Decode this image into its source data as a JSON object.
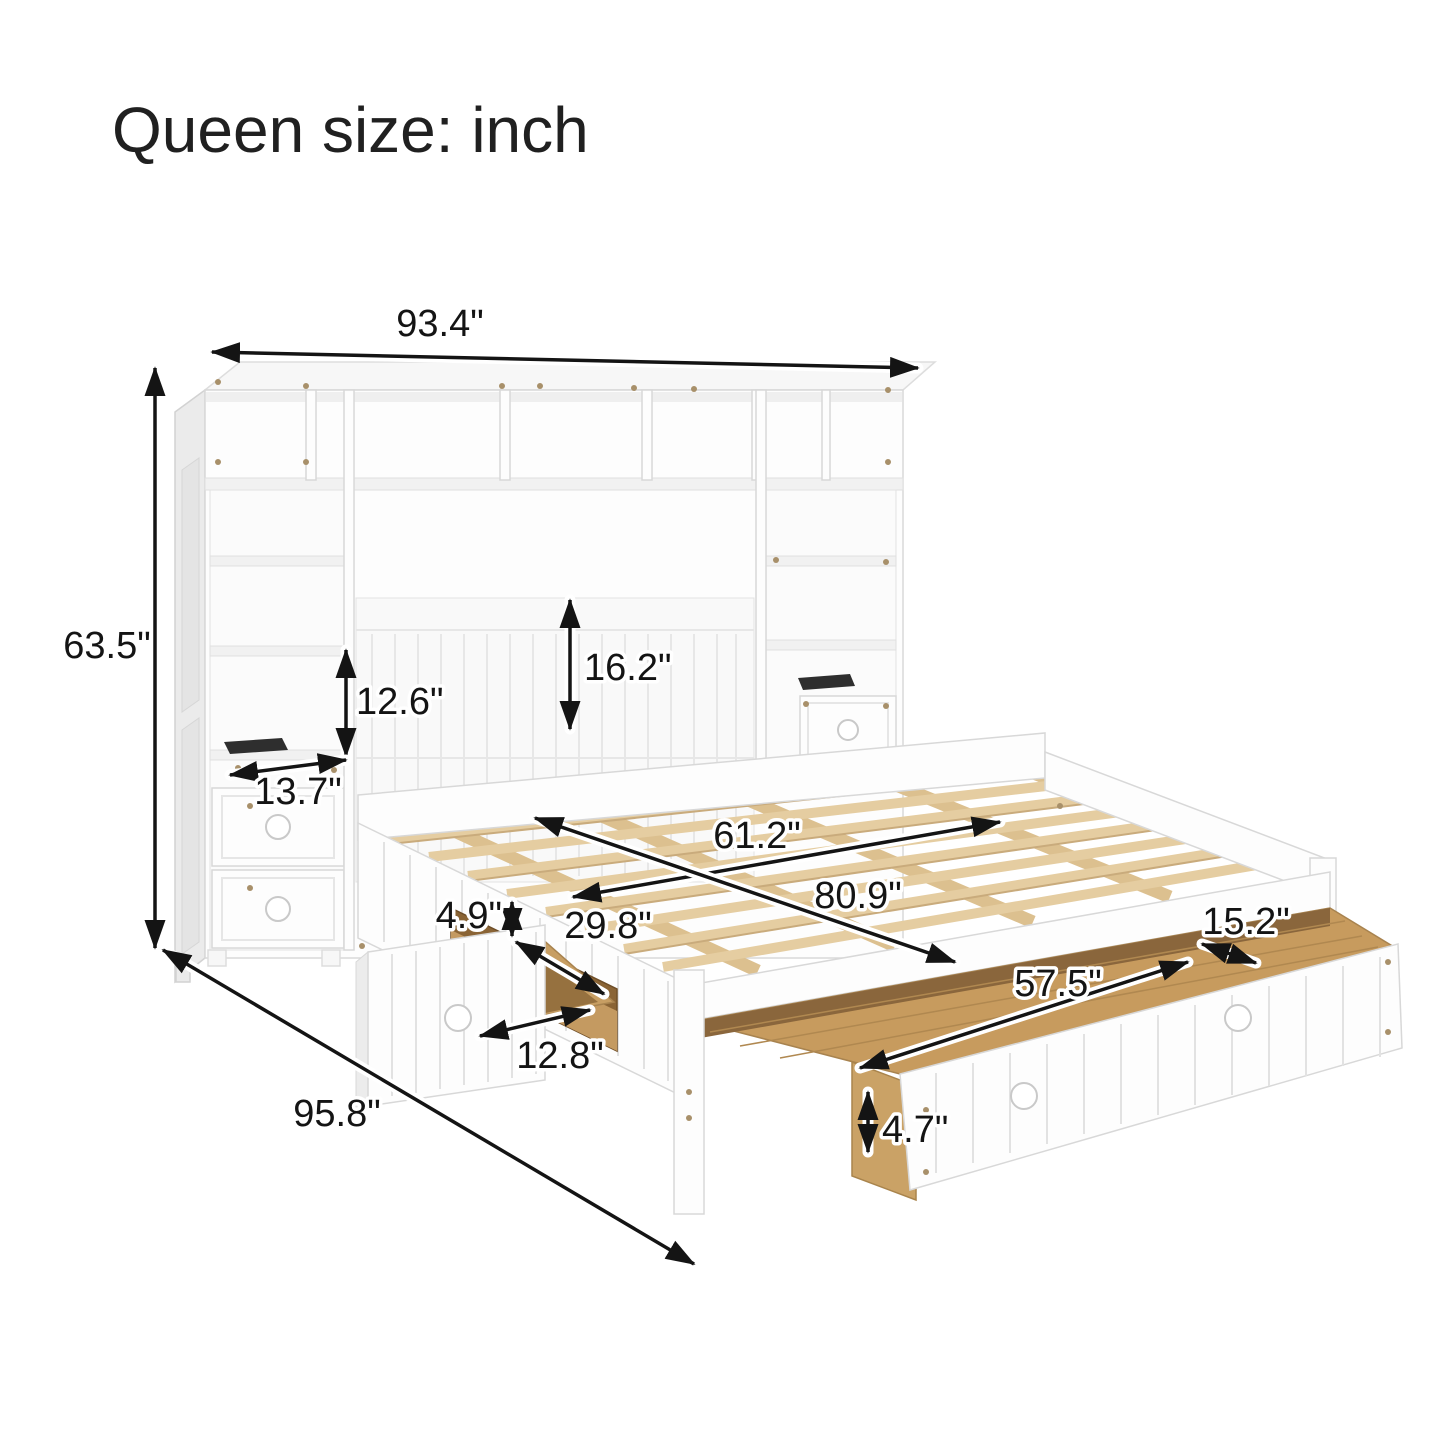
{
  "title": "Queen size: inch",
  "dimensions": {
    "overall_width": "93.4\"",
    "overall_height": "63.5\"",
    "shelf_opening_height": "12.6\"",
    "headboard_panel_height": "16.2\"",
    "tower_shelf_depth": "13.7\"",
    "bed_slat_width": "61.2\"",
    "bed_slat_length": "80.9\"",
    "side_rail_above_drawer": "4.9\"",
    "side_drawer_width": "29.8\"",
    "side_drawer_depth": "12.8\"",
    "foot_drawer_depth": "15.2\"",
    "foot_drawer_width": "57.5\"",
    "foot_drawer_inner_height": "4.7\"",
    "overall_depth": "95.8\""
  },
  "colors": {
    "arrow": "#141414",
    "wood_slat": "#e5cda1",
    "wood_interior": "#c79b5e",
    "furniture_white": "#fdfdfd"
  }
}
